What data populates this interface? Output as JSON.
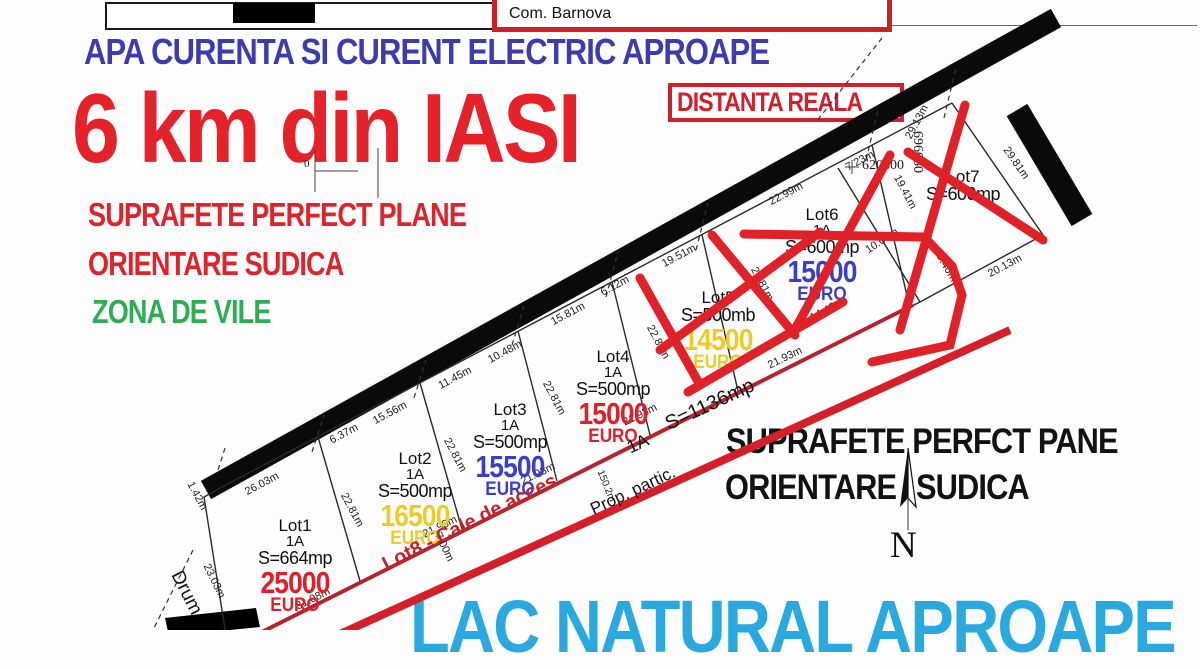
{
  "titlebar": {
    "location": "Com. Barnova"
  },
  "headlines": {
    "utilities": "APA CURENTA SI CURENT ELECTRIC APROAPE",
    "distance": "6 km din IASI",
    "distance_note": "DISTANTA REALA",
    "feature1": "SUPRAFETE PERFECT PLANE",
    "feature2": "ORIENTARE SUDICA",
    "feature3": "ZONA DE VILE",
    "right_line1": "SUPRAFETE PERFCT PANE",
    "right_line2a": "ORIENTARE",
    "right_line2b": "SUDICA",
    "bottom": "LAC NATURAL APROAPE"
  },
  "lots": [
    {
      "name": "Lot1",
      "unit": "1A",
      "area": "S=664mp",
      "price": "25000",
      "currency": "EURO"
    },
    {
      "name": "Lot2",
      "unit": "1A",
      "area": "S=500mp",
      "price": "16500",
      "currency": "EURO"
    },
    {
      "name": "Lot3",
      "unit": "1A",
      "area": "S=500mp",
      "price": "15500",
      "currency": "EURO"
    },
    {
      "name": "Lot4",
      "unit": "1A",
      "area": "S=500mp",
      "price": "15000",
      "currency": "EURO"
    },
    {
      "name": "Lot5",
      "area": "S=500mb",
      "price": "14500",
      "currency": "EURO"
    },
    {
      "name": "Lot6",
      "unit": "1A",
      "area": "S=600mp",
      "price": "15000",
      "currency": "EURO"
    },
    {
      "name": "Lot7",
      "area": "S=600mp"
    }
  ],
  "access_road": {
    "label": "Lot8 - Cale de acces",
    "unit": "1A",
    "area": "S=1136mp",
    "neighbor": "Prop. partic.",
    "street": "Drum",
    "length": "150.2m"
  },
  "coordinates": {
    "x": "620800",
    "y": "696050",
    "zero": "0"
  },
  "compass": {
    "label": "N"
  },
  "dims": [
    "1.42m",
    "26.03m",
    "23.03m",
    "31.08m",
    "22.81m",
    "6.37m",
    "15.56m",
    "21.93m",
    "22.81m",
    "7.00m",
    "11.45m",
    "10.48m",
    "21.93m",
    "22.81m",
    "15.81m",
    "6.12m",
    "21.93m",
    "22.81m",
    "19.51m",
    "21.93m",
    "22.81m",
    "22.99m",
    "7.23m",
    "14.48m",
    "19.41m",
    "10.00m",
    "10.40m",
    "29.13m",
    "29.81m",
    "20.13m",
    "150.2m"
  ],
  "colors": {
    "headline_blue": "#3c3cb0",
    "headline_red": "#e52129",
    "green": "#2eae54",
    "cyan": "#2aa9e1",
    "price_red": "#dd2029",
    "price_yellow": "#eecb28",
    "price_blue": "#3c3ec6",
    "road_red": "#c2242c",
    "frame_red": "#cc2027",
    "black": "#111111"
  }
}
